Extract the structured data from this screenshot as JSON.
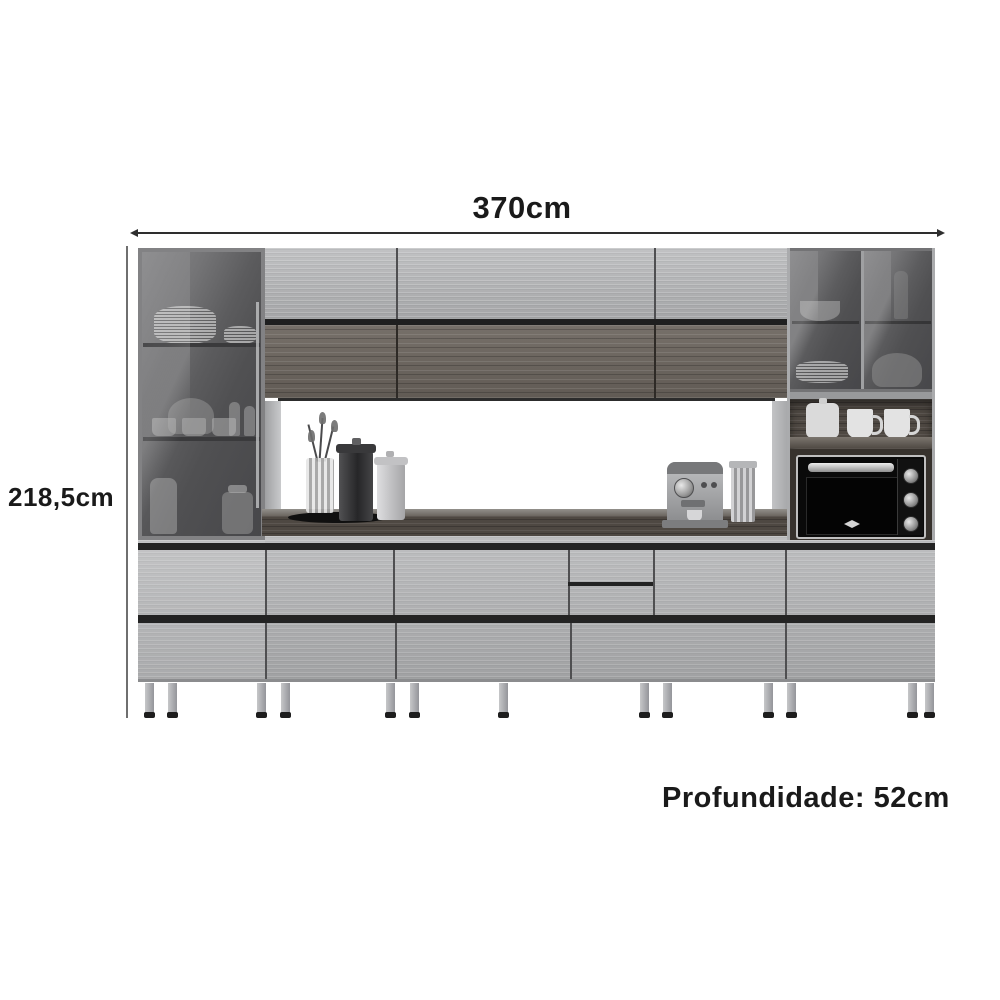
{
  "dimensions": {
    "width": "370cm",
    "height": "218,5cm",
    "depth": "Profundidade: 52cm"
  },
  "colors": {
    "background": "#ffffff",
    "text": "#1a1a1a",
    "dimension_line": "#2e2e2e",
    "door_light_gray": "#b7b8ba",
    "wood_dark": "#6e6760",
    "smoked_glass": "#58585a",
    "counter_wood": "#544e49",
    "appliance_black": "#0a0a0a",
    "leg_metal": "#a9aaac"
  }
}
